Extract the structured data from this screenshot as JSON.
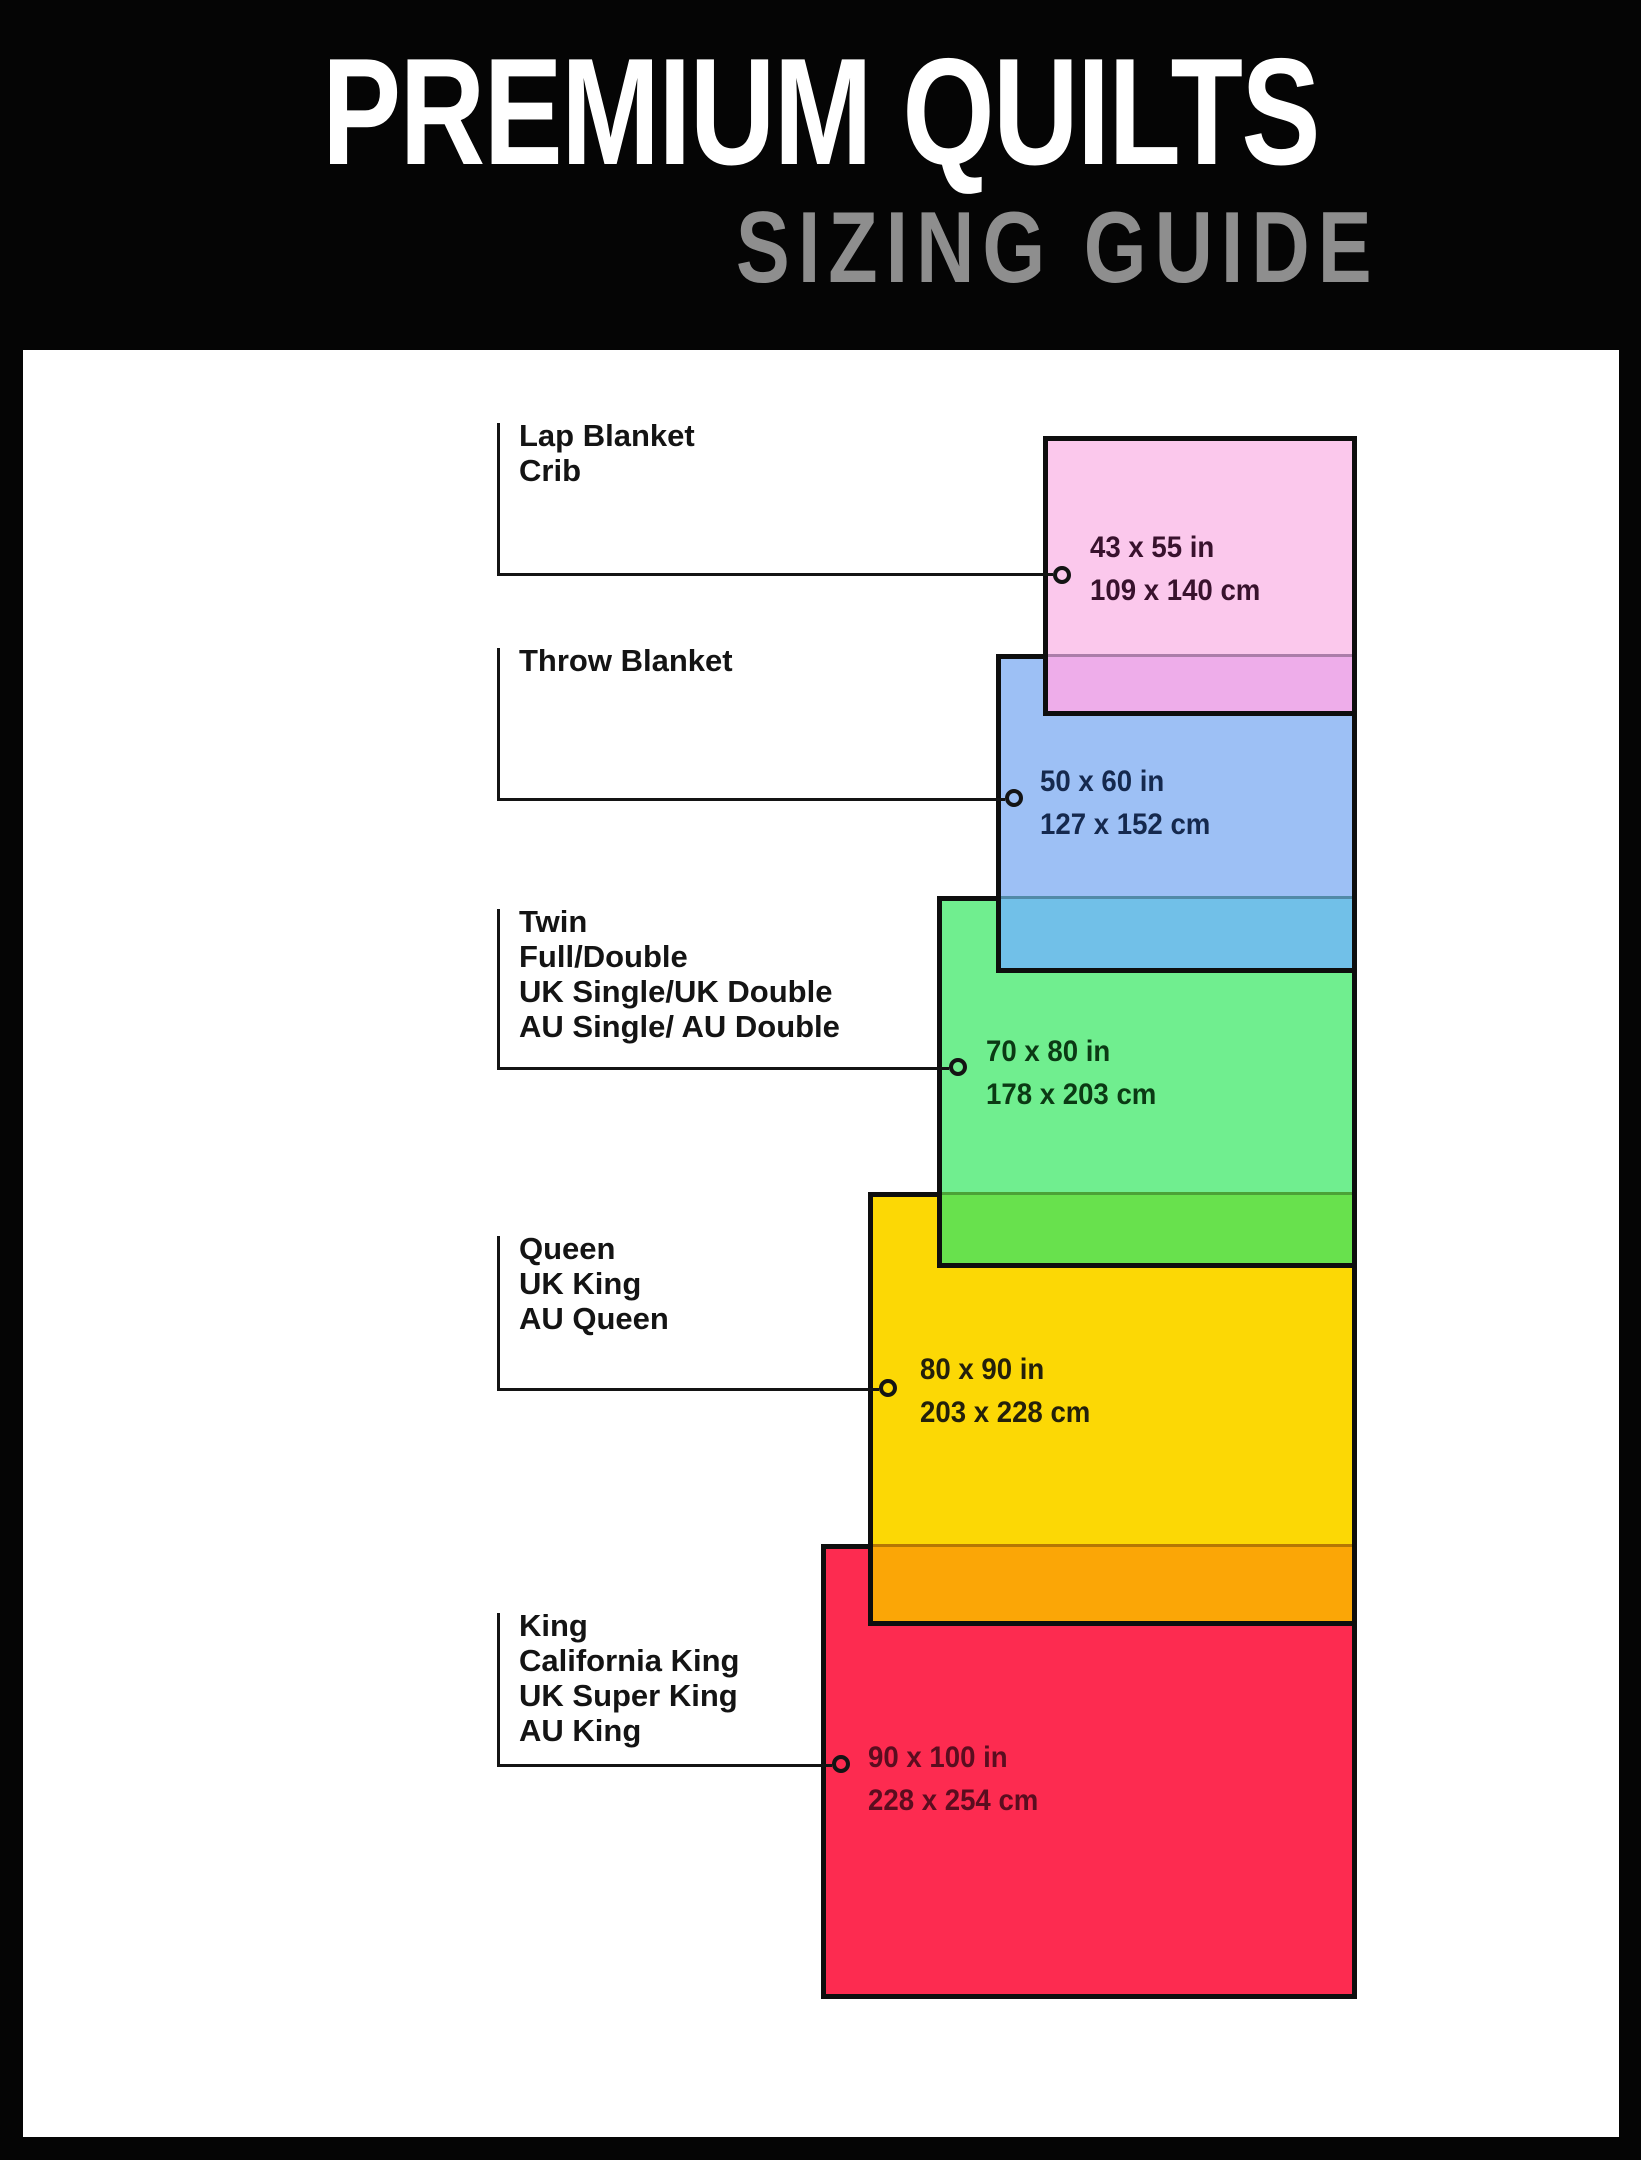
{
  "header": {
    "title": "PREMIUM QUILTS",
    "subtitle": "SIZING GUIDE",
    "title_color": "#ffffff",
    "subtitle_color": "#8e8e8e",
    "background": "#050505"
  },
  "panel": {
    "background": "#ffffff"
  },
  "items": [
    {
      "id": "lap-crib",
      "labels": [
        "Lap Blanket",
        "Crib"
      ],
      "size_in": "43 x 55 in",
      "size_cm": "109 x 140 cm",
      "fill": "#fbc8ec",
      "overlap_fill": "#eeadea",
      "text_color": "#38122d"
    },
    {
      "id": "throw",
      "labels": [
        "Throw Blanket"
      ],
      "size_in": "50 x 60 in",
      "size_cm": "127 x 152 cm",
      "fill": "#9dc0f5",
      "overlap_fill": "#71c0e8",
      "text_color": "#15294e"
    },
    {
      "id": "twin",
      "labels": [
        "Twin",
        "Full/Double",
        "UK Single/UK Double",
        "AU Single/ AU Double"
      ],
      "size_in": "70 x 80 in",
      "size_cm": "178 x 203 cm",
      "fill": "#70ee8f",
      "overlap_fill": "#68e14d",
      "text_color": "#0b3a14"
    },
    {
      "id": "queen",
      "labels": [
        "Queen",
        "UK King",
        "AU Queen"
      ],
      "size_in": "80 x 90 in",
      "size_cm": "203 x 228 cm",
      "fill": "#fcd805",
      "overlap_fill": "#fba606",
      "text_color": "#23200b"
    },
    {
      "id": "king",
      "labels": [
        "King",
        "California King",
        "UK Super King",
        "AU King"
      ],
      "size_in": "90 x 100 in",
      "size_cm": "228 x 254 cm",
      "fill": "#fd2b50",
      "overlap_fill": "",
      "text_color": "#5a0d1f"
    }
  ]
}
